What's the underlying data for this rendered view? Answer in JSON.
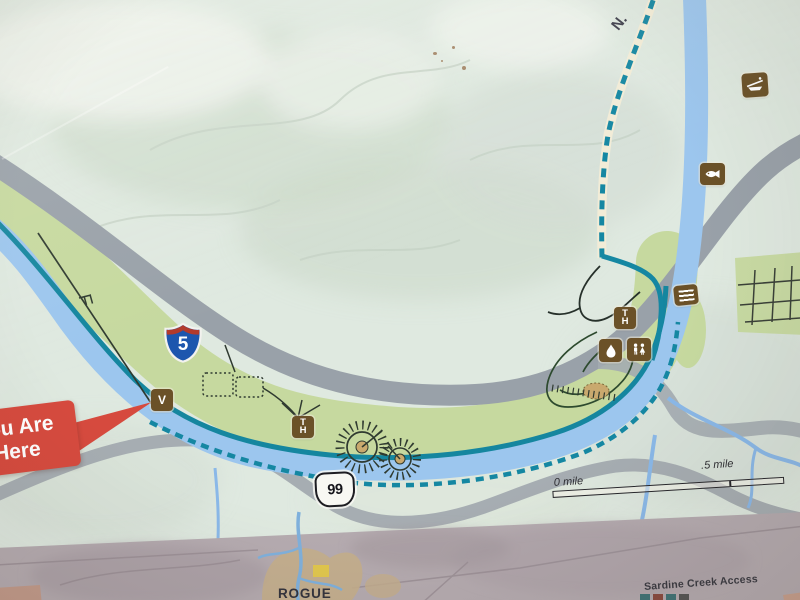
{
  "map": {
    "you_are_here": {
      "line1": "You Are",
      "line2": "Here"
    },
    "interstate_shield_number": "5",
    "route_shield_number": "99",
    "north_label": "N.",
    "scale_bar": {
      "start_label": "0 mile",
      "end_label": ".5 mile"
    },
    "icons": {
      "viewpoint_label": "V",
      "trailhead_label": "TH"
    },
    "colors": {
      "trail_teal": "#1587a2",
      "river_blue": "#9cc6ee",
      "park_green": "#c6d99f",
      "road_gray": "#99a1a9",
      "icon_brown": "#6b5128",
      "marker_red": "#d64a3e",
      "interstate_blue": "#1d56ae",
      "interstate_red": "#b23a2c"
    }
  },
  "inset_map": {
    "town_label": "ROGUE",
    "access_label": "Sardine Creek Access"
  }
}
